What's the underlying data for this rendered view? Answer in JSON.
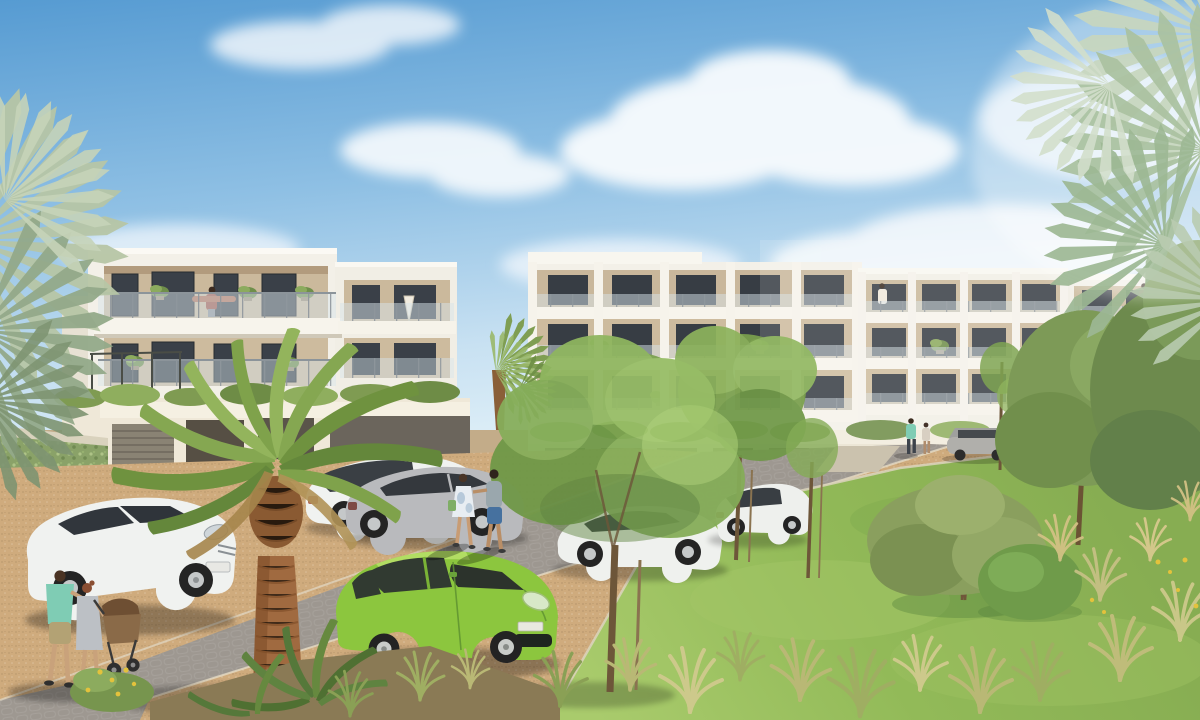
{
  "image": {
    "kind": "architectural-rendering",
    "description": "Sunlit rendering of a modern Mediterranean residential complex: white apartment blocks with recessed balconies and glass railings above a garage row, a cobbled street with parked cars, a lime-green hatchback in the foreground, a tall palm tree, young staked street trees, a grassy meadow at right, and residents strolling.",
    "visible_text": "none"
  },
  "palette": {
    "sky_top": "#569bd2",
    "sky_mid": "#8fc0e4",
    "sky_horizon": "#ddeef7",
    "cloud_white": "#f8fbfd",
    "facade_white": "#f3f0e8",
    "facade_shadow": "#ddd6c6",
    "recess_beige": "#cbb99c",
    "window_glass": "#3a4048",
    "railing_glass": "#d7e4ea",
    "garage_dark": "#5b564b",
    "ivy_green": "#8aa268",
    "road_gray": "#9e9891",
    "gravel_tan": "#cfab7d",
    "pavement_light": "#c8b79e",
    "meadow_green": "#8fb457",
    "meadow_light": "#a9cb6c",
    "tall_grass": "#c6c084",
    "tree_green": "#7ba24f",
    "olive_green": "#8a9f5e",
    "palm_green": "#7fa24b",
    "palm_pale": "#c7d6bf",
    "palm_trunk": "#a06a40",
    "car_green": "#8cc63e",
    "car_white": "#f0f2f0",
    "car_silver": "#b9babd",
    "shirt_teal": "#7fccb4",
    "dress_gray": "#bcc0c5",
    "shorts_blue": "#46719f"
  },
  "sky": {
    "description": "blue sky fading to hazy white near the horizon",
    "cloud_count": 5
  },
  "buildings": [
    {
      "id": "left-block",
      "floors_visible": 2,
      "features": [
        "recessed balconies",
        "glass railings",
        "potted plants",
        "roof terrace",
        "garage doors",
        "ivy covered wall"
      ],
      "person_on_balcony": true
    },
    {
      "id": "middle-block-a",
      "floors_visible": 3,
      "features": [
        "continuous balconies",
        "glass railings",
        "white piers",
        "closed parasol"
      ]
    },
    {
      "id": "middle-block-b",
      "floors_visible": 3,
      "person_on_balcony": true
    },
    {
      "id": "right-block",
      "floors_visible": 3,
      "person_on_balcony": true
    },
    {
      "id": "garage-row",
      "features": [
        "dark garage openings",
        "planted roof edge"
      ]
    }
  ],
  "vehicles": [
    {
      "id": "white-coupe-foreground",
      "color": "white",
      "position": "parked bottom left"
    },
    {
      "id": "silver-hatchback",
      "color": "silver grey",
      "position": "parked along left gravel strip"
    },
    {
      "id": "white-estate",
      "color": "white",
      "position": "parked behind the palm"
    },
    {
      "id": "green-hatchback",
      "color": "lime green",
      "position": "foreground centre, facing right"
    },
    {
      "id": "white-coupe-mid",
      "color": "white",
      "position": "parked under street tree"
    },
    {
      "id": "white-sedan",
      "color": "white",
      "position": "parked along right gravel strip"
    },
    {
      "id": "grey-estate-distant",
      "color": "grey",
      "position": "distant courtyard"
    },
    {
      "id": "white-hatchback-distant",
      "color": "white",
      "position": "distant courtyard"
    },
    {
      "id": "white-car-far-right",
      "color": "white",
      "position": "far right, partly hidden"
    }
  ],
  "people": [
    {
      "id": "family-with-stroller",
      "count": 2,
      "details": "man in teal t-shirt and khaki shorts, woman in grey dress pushing a brown stroller",
      "position": "bottom left"
    },
    {
      "id": "walking-couple",
      "count": 2,
      "details": "woman in light summer dress with green bag, man in grey top and blue shorts",
      "position": "centre street"
    },
    {
      "id": "distant-couple",
      "count": 2,
      "details": "figure in teal shirt with companion",
      "position": "distant courtyard path"
    },
    {
      "id": "balcony-residents",
      "count": 3,
      "position": "balconies of left, middle and right blocks"
    }
  ],
  "vegetation": [
    {
      "id": "foreground-palm",
      "type": "tall palm tree"
    },
    {
      "id": "small-palm",
      "type": "palm between buildings"
    },
    {
      "id": "pale-palm-fronds",
      "type": "fan palm fronds at top right and left edge"
    },
    {
      "id": "street-trees",
      "type": "young staked deciduous trees",
      "count": 4
    },
    {
      "id": "meadow",
      "type": "wild grass meadow with olive bush and clipped shrub"
    },
    {
      "id": "right-trees",
      "type": "olive green trees",
      "count": 2
    },
    {
      "id": "ornamental-grasses",
      "type": "golden grass tufts"
    },
    {
      "id": "cycad",
      "type": "sago palm in planting bed"
    },
    {
      "id": "yellow-wildflowers",
      "type": "flower accents"
    }
  ]
}
